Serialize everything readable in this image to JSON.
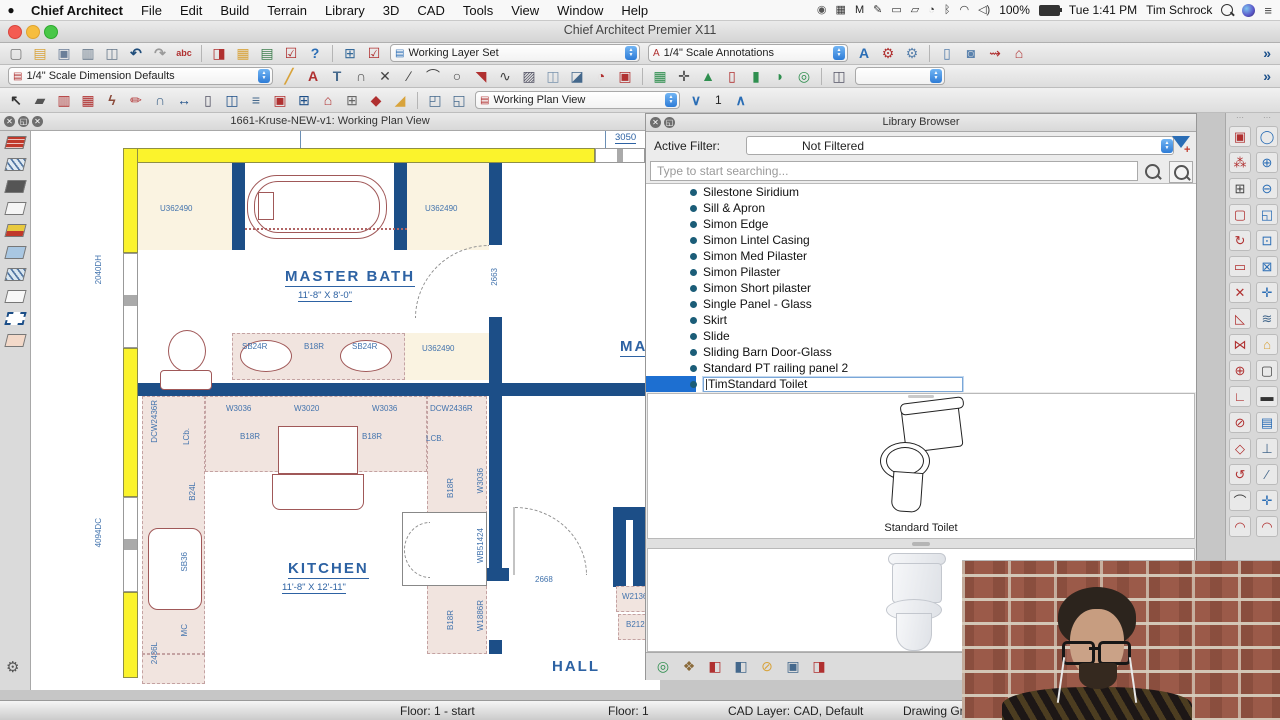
{
  "menubar": {
    "items": [
      {
        "label": "Chief Architect",
        "bold": true
      },
      {
        "label": "File"
      },
      {
        "label": "Edit"
      },
      {
        "label": "Build"
      },
      {
        "label": "Terrain"
      },
      {
        "label": "Library"
      },
      {
        "label": "3D"
      },
      {
        "label": "CAD"
      },
      {
        "label": "Tools"
      },
      {
        "label": "View"
      },
      {
        "label": "Window"
      },
      {
        "label": "Help"
      }
    ],
    "status_icons": [
      {
        "name": "creative-cloud-icon",
        "glyph": "◉",
        "color": "#555"
      },
      {
        "name": "wd-drive-icon",
        "glyph": "▦",
        "color": "#333"
      },
      {
        "name": "malwarebytes-icon",
        "glyph": "M",
        "color": "#222"
      },
      {
        "name": "pen-tablet-icon",
        "glyph": "✎",
        "color": "#333"
      },
      {
        "name": "display-icon",
        "glyph": "▭",
        "color": "#333"
      },
      {
        "name": "airplay-icon",
        "glyph": "▱",
        "color": "#333"
      },
      {
        "name": "time-machine-icon",
        "glyph": "◔",
        "color": "#333"
      },
      {
        "name": "bluetooth-icon",
        "glyph": "ᛒ",
        "color": "#333"
      },
      {
        "name": "wifi-icon",
        "glyph": "◠",
        "color": "#333"
      },
      {
        "name": "volume-icon",
        "glyph": "◁)",
        "color": "#333"
      }
    ],
    "status": {
      "battery_pct": "100%",
      "clock": "Tue 1:41 PM",
      "user": "Tim Schrock",
      "list_glyph": "≡"
    }
  },
  "titlebar": {
    "title": "Chief Architect Premier X11"
  },
  "toolbars": {
    "row1": [
      {
        "t": "i",
        "n": "new-plan",
        "g": "▢",
        "c": "#777"
      },
      {
        "t": "i",
        "n": "open-plan",
        "g": "▤",
        "c": "#d8a33b"
      },
      {
        "t": "i",
        "n": "save-plan",
        "g": "▣",
        "c": "#6b7f99"
      },
      {
        "t": "i",
        "n": "print",
        "g": "▥",
        "c": "#66788a"
      },
      {
        "t": "i",
        "n": "print-preview",
        "g": "◫",
        "c": "#66788a"
      },
      {
        "t": "i",
        "n": "undo",
        "g": "↶",
        "c": "#1f4d7a",
        "b": 1
      },
      {
        "t": "i",
        "n": "redo",
        "g": "↷",
        "c": "#9a9a9a",
        "b": 1
      },
      {
        "t": "i",
        "n": "spell-check",
        "g": "abc",
        "c": "#b03030",
        "sm": 1
      },
      {
        "t": "s"
      },
      {
        "t": "i",
        "n": "layer-display-options",
        "g": "◨",
        "c": "#b03030"
      },
      {
        "t": "i",
        "n": "display-options",
        "g": "▦",
        "c": "#d8a33b"
      },
      {
        "t": "i",
        "n": "active-layer-display",
        "g": "▤",
        "c": "#3f7f4f"
      },
      {
        "t": "i",
        "n": "layer-painter",
        "g": "☑",
        "c": "#b03030"
      },
      {
        "t": "i",
        "n": "help",
        "g": "?",
        "c": "#2a6db5",
        "b": 1
      },
      {
        "t": "s"
      },
      {
        "t": "i",
        "n": "edit-active-view",
        "g": "⊞",
        "c": "#356a9a"
      },
      {
        "t": "i",
        "n": "preferences-check",
        "g": "☑",
        "c": "#b03030"
      },
      {
        "t": "c",
        "n": "layer-set-combo",
        "v": "Working Layer Set",
        "w": 250,
        "ic": "▤",
        "icc": "#2a6db5"
      },
      {
        "t": "c",
        "n": "annotation-set-combo",
        "v": "1/4\" Scale Annotations",
        "w": 200,
        "ic": "A",
        "icc": "#b03030"
      },
      {
        "t": "i",
        "n": "text-style",
        "g": "A",
        "c": "#2a6db5",
        "b": 1
      },
      {
        "t": "i",
        "n": "adjust-defaults-check",
        "g": "⚙",
        "c": "#b03030"
      },
      {
        "t": "i",
        "n": "adjust-defaults",
        "g": "⚙",
        "c": "#5a82ad"
      },
      {
        "t": "s"
      },
      {
        "t": "i",
        "n": "window-areas",
        "g": "▯",
        "c": "#5a82ad"
      },
      {
        "t": "i",
        "n": "camera-view",
        "g": "◙",
        "c": "#5a82ad"
      },
      {
        "t": "i",
        "n": "walkthrough",
        "g": "⇝",
        "c": "#b03030"
      },
      {
        "t": "i",
        "n": "home-overview",
        "g": "⌂",
        "c": "#b03030"
      },
      {
        "t": "o",
        "g": "»"
      }
    ],
    "row2": [
      {
        "t": "c",
        "n": "dimension-defaults-combo",
        "v": "1/4\" Scale Dimension Defaults",
        "w": 265,
        "ic": "▤",
        "icc": "#b03030"
      },
      {
        "t": "i",
        "n": "tape-measure",
        "g": "╱",
        "c": "#d8a33b",
        "b": 1
      },
      {
        "t": "i",
        "n": "text-tool",
        "g": "A",
        "c": "#b03030",
        "b": 1
      },
      {
        "t": "i",
        "n": "leader-line",
        "g": "T",
        "c": "#44688c",
        "b": 1
      },
      {
        "t": "i",
        "n": "node-polyline",
        "g": "∩",
        "c": "#555"
      },
      {
        "t": "i",
        "n": "cross-box",
        "g": "✕",
        "c": "#444"
      },
      {
        "t": "i",
        "n": "line-tool",
        "g": "∕",
        "c": "#444"
      },
      {
        "t": "i",
        "n": "arc-tool",
        "g": "⌒",
        "c": "#444"
      },
      {
        "t": "i",
        "n": "circle-tool",
        "g": "○",
        "c": "#444"
      },
      {
        "t": "i",
        "n": "cad-pointer",
        "g": "◥",
        "c": "#b03030"
      },
      {
        "t": "i",
        "n": "spline-tool",
        "g": "∿",
        "c": "#444"
      },
      {
        "t": "i",
        "n": "hatch-region",
        "g": "▨",
        "c": "#556"
      },
      {
        "t": "i",
        "n": "cad-block",
        "g": "◫",
        "c": "#7a93ad"
      },
      {
        "t": "i",
        "n": "elevation-reference",
        "g": "◪",
        "c": "#44688c"
      },
      {
        "t": "i",
        "n": "door-swing-symbol",
        "g": "◔",
        "c": "#b03030"
      },
      {
        "t": "i",
        "n": "cad-detail",
        "g": "▣",
        "c": "#b03030"
      },
      {
        "t": "s"
      },
      {
        "t": "i",
        "n": "picture-file",
        "g": "▦",
        "c": "#2f8f4f"
      },
      {
        "t": "i",
        "n": "point-marker",
        "g": "✛",
        "c": "#444"
      },
      {
        "t": "i",
        "n": "plant-tool",
        "g": "▲",
        "c": "#2f8f4f"
      },
      {
        "t": "i",
        "n": "cad-detail-management",
        "g": "▯",
        "c": "#b03030"
      },
      {
        "t": "i",
        "n": "millwork-column",
        "g": "▮",
        "c": "#2f8f4f"
      },
      {
        "t": "i",
        "n": "symbol-shape",
        "g": "◗",
        "c": "#2f8f4f"
      },
      {
        "t": "i",
        "n": "plant-chooser",
        "g": "◎",
        "c": "#2f8f4f"
      },
      {
        "t": "s"
      },
      {
        "t": "i",
        "n": "layout-page",
        "g": "◫",
        "c": "#556"
      },
      {
        "t": "c",
        "n": "blank-combo",
        "v": "",
        "w": 90
      },
      {
        "t": "o",
        "g": "»"
      }
    ],
    "row3": [
      {
        "t": "i",
        "n": "select-objects",
        "g": "↖",
        "c": "#333",
        "b": 1
      },
      {
        "t": "i",
        "n": "straight-wall",
        "g": "▰",
        "c": "#555"
      },
      {
        "t": "i",
        "n": "railing-tool",
        "g": "▥",
        "c": "#b03030"
      },
      {
        "t": "i",
        "n": "material-region",
        "g": "▦",
        "c": "#b03030"
      },
      {
        "t": "i",
        "n": "wall-break",
        "g": "ϟ",
        "c": "#8a4a3a",
        "b": 1
      },
      {
        "t": "i",
        "n": "hatch-wall",
        "g": "✏",
        "c": "#b03030"
      },
      {
        "t": "i",
        "n": "curved-wall",
        "g": "∩",
        "c": "#44688c"
      },
      {
        "t": "i",
        "n": "dimension-tool",
        "g": "↔",
        "c": "#1c4e87",
        "b": 1
      },
      {
        "t": "i",
        "n": "door-tool",
        "g": "▯",
        "c": "#556"
      },
      {
        "t": "i",
        "n": "window-tool",
        "g": "◫",
        "c": "#1c4e87"
      },
      {
        "t": "i",
        "n": "stairs-tool",
        "g": "≡",
        "c": "#44688c",
        "b": 1
      },
      {
        "t": "i",
        "n": "fireplace-tool",
        "g": "▣",
        "c": "#b03030"
      },
      {
        "t": "i",
        "n": "cabinet-tool",
        "g": "⊞",
        "c": "#1c4e87"
      },
      {
        "t": "i",
        "n": "roof-tool",
        "g": "⌂",
        "c": "#b03030",
        "b": 1
      },
      {
        "t": "i",
        "n": "framing-tool",
        "g": "⊞",
        "c": "#666"
      },
      {
        "t": "i",
        "n": "tile-tool",
        "g": "◆",
        "c": "#b03030"
      },
      {
        "t": "i",
        "n": "corner-board",
        "g": "◢",
        "c": "#d8a33b"
      },
      {
        "t": "s"
      },
      {
        "t": "i",
        "n": "export-template",
        "g": "◰",
        "c": "#44688c"
      },
      {
        "t": "i",
        "n": "import-template",
        "g": "◱",
        "c": "#44688c"
      },
      {
        "t": "c",
        "n": "plan-view-combo",
        "v": "Working Plan View",
        "w": 205,
        "ic": "▤",
        "icc": "#b03030"
      },
      {
        "t": "i",
        "n": "floor-down",
        "g": "∨",
        "c": "#2a6db5",
        "b": 1
      },
      {
        "t": "x",
        "n": "current-floor-number",
        "v": "1"
      },
      {
        "t": "i",
        "n": "floor-up",
        "g": "∧",
        "c": "#2a6db5",
        "b": 1
      }
    ],
    "page_number": "1"
  },
  "left_toolbar": {
    "icons": [
      {
        "name": "brick-wall",
        "bg": "#c0392b",
        "hatch": "brick"
      },
      {
        "name": "glass-wall",
        "bg": "#dfe9f2",
        "hatch": "diag"
      },
      {
        "name": "solid-wall",
        "bg": "#555555"
      },
      {
        "name": "railing-wall",
        "bg": "#f5f5f5"
      },
      {
        "name": "foundation-wall",
        "bg": "#e8c93e",
        "hatch": "half-red"
      },
      {
        "name": "half-wall-blue",
        "bg": "#a9c7e2"
      },
      {
        "name": "half-wall-hatch",
        "bg": "#d8e6f0",
        "hatch": "diag"
      },
      {
        "name": "half-wall-white",
        "bg": "#f8f8f8"
      },
      {
        "name": "invisible-wall",
        "dashed": true
      },
      {
        "name": "partition-wall",
        "bg": "#f3d9c9"
      }
    ],
    "gear_glyph": "⚙"
  },
  "plan_window": {
    "title": "1661-Kruse-NEW-v1:  Working Plan View",
    "labels": [
      {
        "t": "3050",
        "x": 585,
        "y": 2,
        "cls": "dim"
      },
      {
        "t": "U362490",
        "x": 130,
        "y": 74,
        "cls": "cab"
      },
      {
        "t": "U362490",
        "x": 395,
        "y": 74,
        "cls": "cab"
      },
      {
        "t": "2040DH",
        "x": 64,
        "y": 125,
        "cls": "cabr"
      },
      {
        "t": "MASTER BATH",
        "x": 255,
        "y": 138,
        "cls": "room"
      },
      {
        "t": "11'-8\" X 8'-0\"",
        "x": 268,
        "y": 160,
        "cls": "dim"
      },
      {
        "t": "2663",
        "x": 460,
        "y": 138,
        "cls": "cabr"
      },
      {
        "t": "SB24R",
        "x": 212,
        "y": 212,
        "cls": "cab"
      },
      {
        "t": "B18R",
        "x": 274,
        "y": 212,
        "cls": "cab"
      },
      {
        "t": "SB24R",
        "x": 322,
        "y": 212,
        "cls": "cab"
      },
      {
        "t": "U362490",
        "x": 392,
        "y": 214,
        "cls": "cab"
      },
      {
        "t": "DCW2436R",
        "x": 120,
        "y": 270,
        "cls": "cabr"
      },
      {
        "t": "W3036",
        "x": 196,
        "y": 274,
        "cls": "cab"
      },
      {
        "t": "W3020",
        "x": 264,
        "y": 274,
        "cls": "cab"
      },
      {
        "t": "W3036",
        "x": 342,
        "y": 274,
        "cls": "cab"
      },
      {
        "t": "DCW2436R",
        "x": 400,
        "y": 274,
        "cls": "cab"
      },
      {
        "t": "LCb.",
        "x": 152,
        "y": 298,
        "cls": "cabr"
      },
      {
        "t": "B18R",
        "x": 210,
        "y": 302,
        "cls": "cab"
      },
      {
        "t": "B18R",
        "x": 332,
        "y": 302,
        "cls": "cab"
      },
      {
        "t": "LCB.",
        "x": 396,
        "y": 304,
        "cls": "cab"
      },
      {
        "t": "B24L",
        "x": 158,
        "y": 352,
        "cls": "cabr"
      },
      {
        "t": "4094DC",
        "x": 64,
        "y": 388,
        "cls": "cabr"
      },
      {
        "t": "SB36",
        "x": 150,
        "y": 422,
        "cls": "cabr"
      },
      {
        "t": "MC",
        "x": 150,
        "y": 494,
        "cls": "cabr"
      },
      {
        "t": "2436L",
        "x": 120,
        "y": 512,
        "cls": "cabr"
      },
      {
        "t": "KITCHEN",
        "x": 258,
        "y": 430,
        "cls": "room"
      },
      {
        "t": "11'-8\" X 12'-11\"",
        "x": 252,
        "y": 452,
        "cls": "dim"
      },
      {
        "t": "B18R",
        "x": 416,
        "y": 348,
        "cls": "cabr"
      },
      {
        "t": "W3036",
        "x": 446,
        "y": 338,
        "cls": "cabr"
      },
      {
        "t": "WB51424",
        "x": 446,
        "y": 398,
        "cls": "cabr"
      },
      {
        "t": "B18R",
        "x": 416,
        "y": 480,
        "cls": "cabr"
      },
      {
        "t": "W1886R",
        "x": 446,
        "y": 470,
        "cls": "cabr"
      },
      {
        "t": "2668",
        "x": 505,
        "y": 445,
        "cls": "cab"
      },
      {
        "t": "W2136",
        "x": 592,
        "y": 462,
        "cls": "cab"
      },
      {
        "t": "B2121",
        "x": 596,
        "y": 490,
        "cls": "cab"
      },
      {
        "t": "MA",
        "x": 590,
        "y": 208,
        "cls": "room"
      },
      {
        "t": "HALL",
        "x": 522,
        "y": 528,
        "cls": "roomn"
      }
    ]
  },
  "library": {
    "title": "Library Browser",
    "active_filter_label": "Active Filter:",
    "active_filter_value": "Not Filtered",
    "search_placeholder": "Type to start searching...",
    "items": [
      "Silestone Siridium",
      "Sill & Apron",
      "Simon Edge",
      "Simon Lintel Casing",
      "Simon Med Pilaster",
      "Simon Pilaster",
      "Simon Short pilaster",
      "Single Panel - Glass",
      "Skirt",
      "Slide",
      "Sliding Barn Door-Glass",
      "Standard PT railing panel 2"
    ],
    "selected_item": "TimStandard Toilet",
    "preview_caption": "Standard Toilet",
    "toolbar": [
      {
        "t": "i",
        "n": "plant-finder",
        "g": "◎",
        "c": "#2f8f4f"
      },
      {
        "t": "i",
        "n": "materials-painter",
        "g": "❖",
        "c": "#8a6a3a"
      },
      {
        "t": "i",
        "n": "library-panel-add",
        "g": "◧",
        "c": "#b03030"
      },
      {
        "t": "i",
        "n": "library-panel-check",
        "g": "◧",
        "c": "#44688c"
      },
      {
        "t": "i",
        "n": "filters-toggle",
        "g": "⊘",
        "c": "#d8a33b"
      },
      {
        "t": "i",
        "n": "show-in-3d",
        "g": "▣",
        "c": "#44688c"
      },
      {
        "t": "i",
        "n": "export-library",
        "g": "◨",
        "c": "#b03030"
      }
    ]
  },
  "right_toolbar": {
    "left_column": [
      {
        "name": "transform-replicate",
        "glyph": "▣",
        "color": "#b03030"
      },
      {
        "name": "sprinkle-objects",
        "glyph": "⁂",
        "color": "#b03030"
      },
      {
        "name": "grid-snaps",
        "glyph": "⊞",
        "color": "#444"
      },
      {
        "name": "select-marquee",
        "glyph": "▢",
        "color": "#b03030"
      },
      {
        "name": "rotate-tool",
        "glyph": "↻",
        "color": "#b03030"
      },
      {
        "name": "reshape-rectangle",
        "glyph": "▭",
        "color": "#b03030"
      },
      {
        "name": "trim-objects",
        "glyph": "✕",
        "color": "#b03030"
      },
      {
        "name": "fillet-corner",
        "glyph": "◺",
        "color": "#b03030"
      },
      {
        "name": "mirror-objects",
        "glyph": "⋈",
        "color": "#b03030"
      },
      {
        "name": "center-object",
        "glyph": "⊕",
        "color": "#b03030"
      },
      {
        "name": "angle-edit",
        "glyph": "∟",
        "color": "#b03030"
      },
      {
        "name": "disconnect-edges",
        "glyph": "⊘",
        "color": "#b03030"
      },
      {
        "name": "polygon-edit",
        "glyph": "◇",
        "color": "#b03030"
      },
      {
        "name": "rotate-about-point",
        "glyph": "↺",
        "color": "#b03030"
      },
      {
        "name": "arc-create",
        "glyph": "⌒",
        "color": "#444"
      },
      {
        "name": "curve-edit",
        "glyph": "◠",
        "color": "#b03030"
      }
    ],
    "right_column": [
      {
        "name": "zoom",
        "glyph": "◯",
        "color": "#2a6db5"
      },
      {
        "name": "zoom-in",
        "glyph": "⊕",
        "color": "#2a6db5"
      },
      {
        "name": "zoom-out",
        "glyph": "⊖",
        "color": "#2a6db5"
      },
      {
        "name": "undo-zoom",
        "glyph": "◱",
        "color": "#2a6db5"
      },
      {
        "name": "fill-window",
        "glyph": "⊡",
        "color": "#2a6db5"
      },
      {
        "name": "fill-window-center",
        "glyph": "⊠",
        "color": "#2a6db5"
      },
      {
        "name": "pan-window",
        "glyph": "✛",
        "color": "#2a6db5"
      },
      {
        "name": "layer-sets",
        "glyph": "≋",
        "color": "#44688c"
      },
      {
        "name": "reference-floor",
        "glyph": "⌂",
        "color": "#d8a33b"
      },
      {
        "name": "blank-view",
        "glyph": "▢",
        "color": "#444"
      },
      {
        "name": "section-marker",
        "glyph": "▬",
        "color": "#333"
      },
      {
        "name": "preview-pane",
        "glyph": "▤",
        "color": "#2a6db5"
      },
      {
        "name": "break-edit",
        "glyph": "⊥",
        "color": "#44688c"
      },
      {
        "name": "line-angle",
        "glyph": "∕",
        "color": "#44688c"
      },
      {
        "name": "cross-marker",
        "glyph": "✛",
        "color": "#2a6db5"
      },
      {
        "name": "compass-arc",
        "glyph": "◠",
        "color": "#b03030"
      }
    ]
  },
  "statusbar": {
    "floor_start": "Floor: 1 - start",
    "floor": "Floor: 1",
    "cad_layer": "CAD Layer: CAD,  Default",
    "drawing_group": "Drawing Group: -"
  }
}
